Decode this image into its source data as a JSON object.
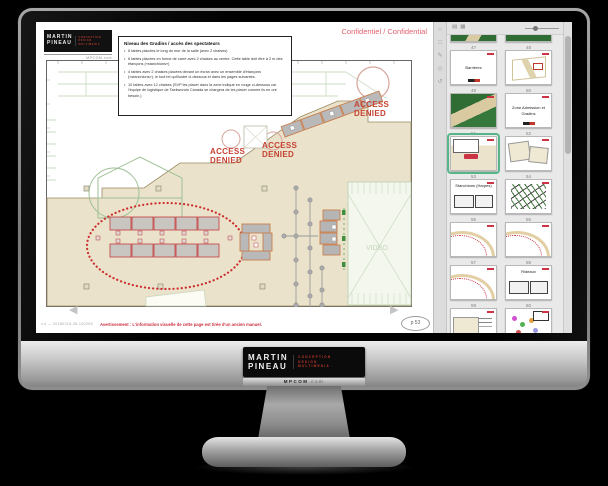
{
  "header": {
    "confidential": "Confidentiel / Confidential"
  },
  "brand": {
    "first": "Martin",
    "last": "Pineau",
    "tagline": [
      "CONCEPTION",
      "DESIGN",
      "MULTIMEDIA"
    ],
    "site": "MPCOM",
    "site_suffix": ".com"
  },
  "notes": {
    "title": "Niveau des Gradins / accès des spectateurs",
    "bullets": [
      "6 tables placées le long du mur de la salle (avec 2 chaises)",
      "6 tables placées en forme de carré avec 2 chaises au centre. Cette table doit être à 2 m des étançons («stanchions»)",
      "4 tables avec 2 chaises placées devant un écran avec un ensemble d'étançons («stanchions»), le tout tel qu'illustré ci-dessous et dans les pages suivantes.",
      "10 tables avec 12 chaises (SVP les placer dans la zone indiqué en rouge ci-dessous car l'équipe de logistique de Taekwondo Canada se chargera de les placer comme ils en ont besoin.)"
    ]
  },
  "plan": {
    "access_word1": "ACCESS",
    "access_word2": "DENIED",
    "video_label": "VIDEO"
  },
  "statusbar": {
    "version": "v.4 — 20180318-28-140208",
    "warning": "Avertissement : L'information visuelle de cette page est tirée d'un ancien manuel.",
    "page_label": "p 53",
    "prev_glyph": "◀",
    "next_glyph": "▶"
  },
  "sidebar": {
    "tools": [
      {
        "name": "magnifier-icon",
        "glyph": "○"
      },
      {
        "name": "page-icon",
        "glyph": "□"
      },
      {
        "name": "pencil-icon",
        "glyph": "✎"
      },
      {
        "name": "shape-icon",
        "glyph": "◇"
      },
      {
        "name": "rotate-icon",
        "glyph": "↺"
      }
    ],
    "panel_tools": [
      {
        "name": "thumbnails-view-icon",
        "glyph": "▤"
      },
      {
        "name": "grid-view-icon",
        "glyph": "▦"
      }
    ],
    "thumbnails": [
      {
        "num": "47",
        "type": "t-green-a"
      },
      {
        "num": "48",
        "type": "t-green-b"
      },
      {
        "num": "49",
        "type": "t-white-title",
        "label": "Barrières"
      },
      {
        "num": "50",
        "type": "t-iso"
      },
      {
        "num": "51",
        "type": "t-green-c"
      },
      {
        "num": "52",
        "type": "t-white-title",
        "label": "Zone Admission et Gradins"
      },
      {
        "num": "53",
        "type": "t-mini-plan",
        "selected": true
      },
      {
        "num": "54",
        "type": "t-two-panel"
      },
      {
        "num": "55",
        "type": "t-title-boxes",
        "label": "Stanchions (Harpes)"
      },
      {
        "num": "56",
        "type": "t-hatch"
      },
      {
        "num": "57",
        "type": "t-curve"
      },
      {
        "num": "58",
        "type": "t-curve"
      },
      {
        "num": "59",
        "type": "t-curve"
      },
      {
        "num": "60",
        "type": "t-title-boxes",
        "label": "Rideaux"
      },
      {
        "num": "61",
        "type": "t-wide"
      },
      {
        "num": "62",
        "type": "t-colorful"
      }
    ]
  },
  "colors": {
    "accent_red": "#cc3344",
    "access_denied_red": "#c64232",
    "confidential_pink": "#e26272",
    "selection_green": "#55b488",
    "floor_beige": "#eae2cb",
    "plan_green": "#9fc096",
    "slide_green": "#2f6d35"
  }
}
